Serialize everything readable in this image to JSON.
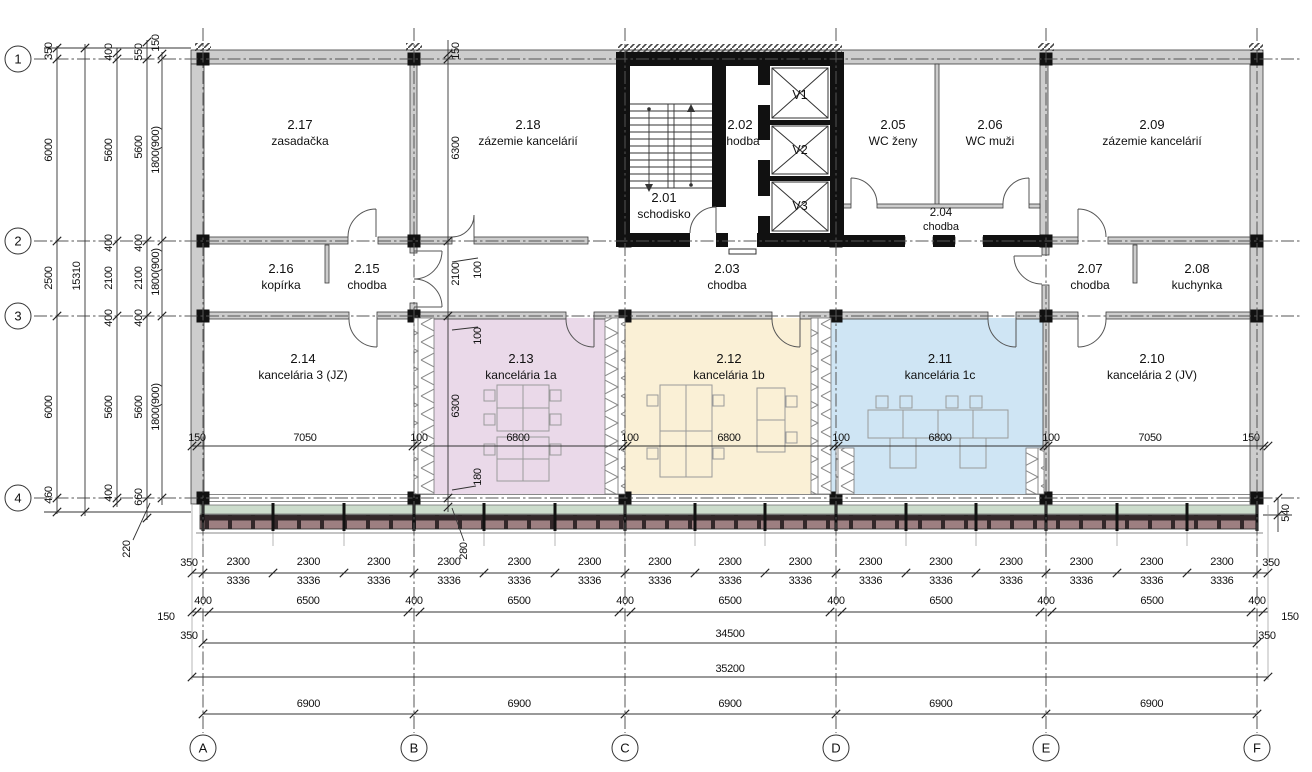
{
  "grid": {
    "rows": [
      "1",
      "2",
      "3",
      "4"
    ],
    "cols": [
      "A",
      "B",
      "C",
      "D",
      "E",
      "F"
    ]
  },
  "rooms": [
    {
      "num": "2.01",
      "name": "schodisko"
    },
    {
      "num": "2.02",
      "name": "chodba"
    },
    {
      "num": "2.03",
      "name": "chodba"
    },
    {
      "num": "2.04",
      "name": "chodba"
    },
    {
      "num": "2.05",
      "name": "WC ženy"
    },
    {
      "num": "2.06",
      "name": "WC muži"
    },
    {
      "num": "2.07",
      "name": "chodba"
    },
    {
      "num": "2.08",
      "name": "kuchynka"
    },
    {
      "num": "2.09",
      "name": "zázemie kancelárií"
    },
    {
      "num": "2.10",
      "name": "kancelária 2 (JV)"
    },
    {
      "num": "2.11",
      "name": "kancelária 1c"
    },
    {
      "num": "2.12",
      "name": "kancelária 1b"
    },
    {
      "num": "2.13",
      "name": "kancelária 1a"
    },
    {
      "num": "2.14",
      "name": "kancelária 3 (JZ)"
    },
    {
      "num": "2.15",
      "name": "chodba"
    },
    {
      "num": "2.16",
      "name": "kopírka"
    },
    {
      "num": "2.17",
      "name": "zasadačka"
    },
    {
      "num": "2.18",
      "name": "zázemie kancelárií"
    }
  ],
  "elevators": [
    "V1",
    "V2",
    "V3"
  ],
  "dims": {
    "col1": [
      "350",
      "6000",
      "2500",
      "6000",
      "460"
    ],
    "col2": "15310",
    "col3": [
      "400",
      "5600",
      "400",
      "2100",
      "400",
      "5600",
      "400"
    ],
    "col4": [
      "550",
      "5600",
      "400",
      "2100",
      "400",
      "5600",
      "660"
    ],
    "col5": [
      "150",
      "1800(900)",
      "1800(900)",
      "1800(900)",
      "220"
    ],
    "mid": [
      "150",
      "6300",
      "2100",
      "100",
      "100",
      "6300",
      "180",
      "280"
    ],
    "widths": [
      "150",
      "7050",
      "100",
      "6800",
      "100",
      "6800",
      "100",
      "6800",
      "100",
      "7050",
      "150"
    ],
    "row2300_left": "350",
    "row2300": [
      "2300",
      "2300",
      "2300",
      "2300",
      "2300",
      "2300",
      "2300",
      "2300",
      "2300",
      "2300",
      "2300",
      "2300",
      "2300",
      "2300",
      "2300"
    ],
    "row2300_right": "350",
    "row3336": [
      "3336",
      "3336",
      "3336",
      "3336",
      "3336",
      "3336",
      "3336",
      "3336",
      "3336",
      "3336",
      "3336",
      "3336",
      "3336",
      "3336",
      "3336"
    ],
    "module": [
      "400",
      "6500",
      "400",
      "6500",
      "400",
      "6500",
      "400",
      "6500",
      "400",
      "6500",
      "400"
    ],
    "module_left": [
      "150",
      "350"
    ],
    "module_right": [
      "150",
      "350"
    ],
    "total_a": "34500",
    "total_b": "35200",
    "row6900": [
      "6900",
      "6900",
      "6900",
      "6900",
      "6900"
    ],
    "right_540": "540"
  },
  "colors": {
    "office_1a": "#ead9e9",
    "office_1b": "#faf0d6",
    "office_1c": "#cfe5f4",
    "facade_glass": "#ccdccc",
    "facade_louver": "#9d7f81"
  }
}
